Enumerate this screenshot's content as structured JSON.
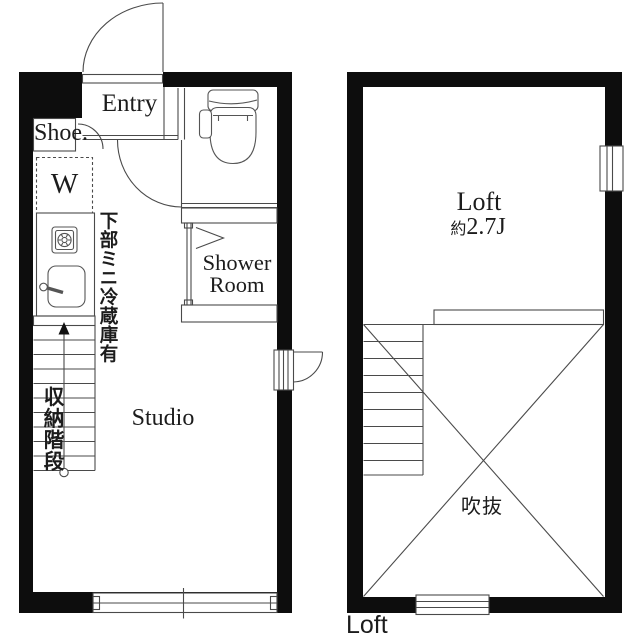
{
  "canvas": {
    "width": 640,
    "height": 639,
    "bg": "#ffffff",
    "wall_color": "#0d0d0d",
    "line_color": "#4a4a4a",
    "text_color": "#1c1c1c"
  },
  "studio_floor": {
    "rooms": {
      "entry_label": "Entry",
      "shoe_label": "Shoe.",
      "washer_label": "W",
      "shower_line1": "Shower",
      "shower_line2": "Room",
      "studio_label": "Studio"
    },
    "notes": {
      "fridge_note": "下部ミニ冷蔵庫有",
      "stairs_note": "収納階段"
    },
    "fixtures": [
      "front-door",
      "entry-sill",
      "shoe-cabinet",
      "toilet",
      "interior-door",
      "shower-bifold-door",
      "washer-space",
      "stove",
      "sink",
      "storage-stairs",
      "side-door",
      "sliding-window"
    ]
  },
  "loft_floor": {
    "rooms": {
      "loft_label": "Loft",
      "loft_size_prefix": "約",
      "loft_size_value": "2.7J",
      "void_label": "吹抜"
    },
    "caption": "Loft",
    "fixtures": [
      "loft-stairs",
      "void-cross",
      "loft-ledge",
      "window-right",
      "window-bottom"
    ]
  }
}
